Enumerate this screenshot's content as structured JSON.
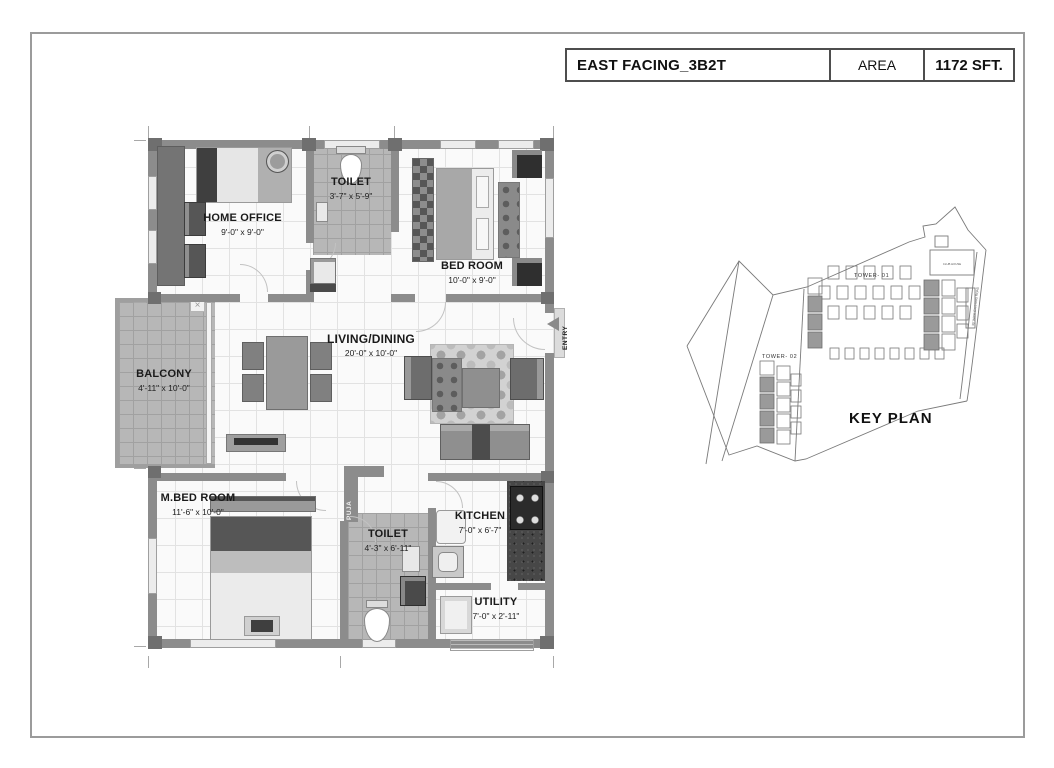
{
  "title_block": {
    "title": "EAST FACING_3B2T",
    "area_label": "AREA",
    "area_value": "1172 SFT."
  },
  "floor_plan": {
    "rooms": [
      {
        "name": "HOME OFFICE",
        "dims": "9'-0\" x 9'-0\""
      },
      {
        "name": "TOILET",
        "dims": "3'-7\" x 5'-9\""
      },
      {
        "name": "BED ROOM",
        "dims": "10'-0\" x 9'-0\""
      },
      {
        "name": "BALCONY",
        "dims": "4'-11\" x 10'-0\""
      },
      {
        "name": "LIVING/DINING",
        "dims": "20'-0\" x 10'-0\""
      },
      {
        "name": "M.BED ROOM",
        "dims": "11'-6\" x 10'-0\""
      },
      {
        "name": "TOILET",
        "dims": "4'-3\" x 6'-11\""
      },
      {
        "name": "KITCHEN",
        "dims": "7'-0\" x 6'-7\""
      },
      {
        "name": "UTILITY",
        "dims": "7'-0\" x 2'-11\""
      }
    ],
    "puja_label": "PUJA",
    "entry_label": "ENTRY",
    "balcony_mark": "×"
  },
  "key_plan": {
    "title": "KEY PLAN",
    "tower_01": "TOWER- 01",
    "tower_02": "TOWER- 02",
    "club_house": "CLUB HOUSE",
    "road_label": "30' WIDE EXISTING ROAD"
  },
  "colors": {
    "wall": "#8c8c8c",
    "wall_dark": "#6f6f6f",
    "tile": "#b7b7b7",
    "frame_border": "#9b9b9b",
    "title_border": "#4e4e4e"
  }
}
